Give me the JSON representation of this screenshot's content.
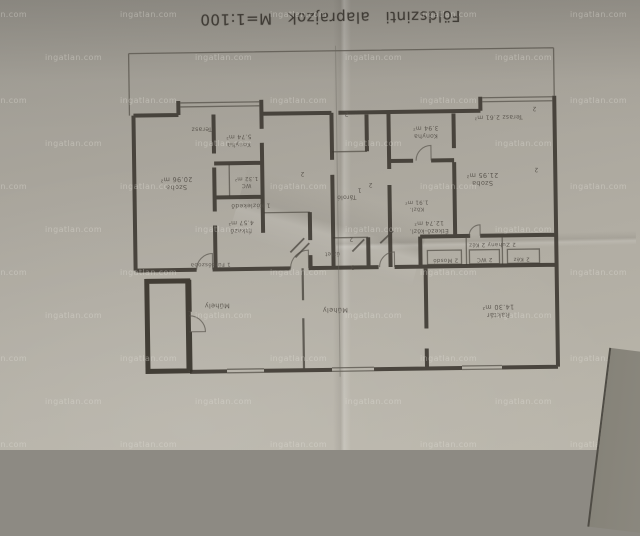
{
  "title": "Földszinti alaprajzok M=1:100",
  "watermark": {
    "text": "ingatlan.com"
  },
  "plan": {
    "labels": [
      {
        "text": "Terasz",
        "x": 203,
        "y": 127,
        "fs": 6
      },
      {
        "text": "Konyha\n5.74 m²",
        "x": 240,
        "y": 139,
        "fs": 6
      },
      {
        "text": "WC\n1.32 m²",
        "x": 247,
        "y": 180,
        "fs": 5.5
      },
      {
        "text": "Szoba\n20.96 m²",
        "x": 177,
        "y": 181,
        "fs": 6.5
      },
      {
        "text": "1 Közlekedő",
        "x": 251,
        "y": 204,
        "fs": 6
      },
      {
        "text": "Étkező\n4.57 m²",
        "x": 241,
        "y": 225,
        "fs": 6
      },
      {
        "text": "1 Fürdőszoba",
        "x": 210,
        "y": 262,
        "fs": 5.5
      },
      {
        "text": "Tároló",
        "x": 347,
        "y": 197,
        "fs": 6
      },
      {
        "text": "üzlet",
        "x": 332,
        "y": 253,
        "fs": 5.5
      },
      {
        "text": "Terasz  2.61 m²",
        "x": 500,
        "y": 119,
        "fs": 6
      },
      {
        "text": "Konyha\n3.94 m²",
        "x": 427,
        "y": 133,
        "fs": 6
      },
      {
        "text": "Szoba\n21.95 m²",
        "x": 483,
        "y": 181,
        "fs": 6.5
      },
      {
        "text": "Közl.\n1.91 m²",
        "x": 417,
        "y": 206,
        "fs": 5.5
      },
      {
        "text": "Étkező-közl.\n12.74 m²",
        "x": 429,
        "y": 228,
        "fs": 6
      },
      {
        "text": "2 Zuhany   2 Kéz",
        "x": 492,
        "y": 246,
        "fs": 5.5
      },
      {
        "text": "2 Mosdó",
        "x": 445,
        "y": 261,
        "fs": 5.5
      },
      {
        "text": "2 WC",
        "x": 484,
        "y": 261,
        "fs": 5.5
      },
      {
        "text": "2 Kéz",
        "x": 521,
        "y": 261,
        "fs": 5.5
      },
      {
        "text": "Műhely",
        "x": 216,
        "y": 304,
        "fs": 6.5
      },
      {
        "text": "Műhely",
        "x": 334,
        "y": 310,
        "fs": 6.5
      },
      {
        "text": "Raktár\n14.30 m²",
        "x": 497,
        "y": 313,
        "fs": 6.5
      },
      {
        "text": "1",
        "x": 360,
        "y": 190,
        "fs": 6
      },
      {
        "text": "2",
        "x": 371,
        "y": 185,
        "fs": 6
      },
      {
        "text": "2",
        "x": 348,
        "y": 114,
        "fs": 6
      },
      {
        "text": "2",
        "x": 536,
        "y": 111,
        "fs": 6
      },
      {
        "text": "2",
        "x": 303,
        "y": 173,
        "fs": 6
      },
      {
        "text": "2",
        "x": 537,
        "y": 172,
        "fs": 6
      },
      {
        "text": "2",
        "x": 351,
        "y": 239,
        "fs": 6
      },
      {
        "text": "3",
        "x": 352,
        "y": 267,
        "fs": 6
      }
    ]
  }
}
